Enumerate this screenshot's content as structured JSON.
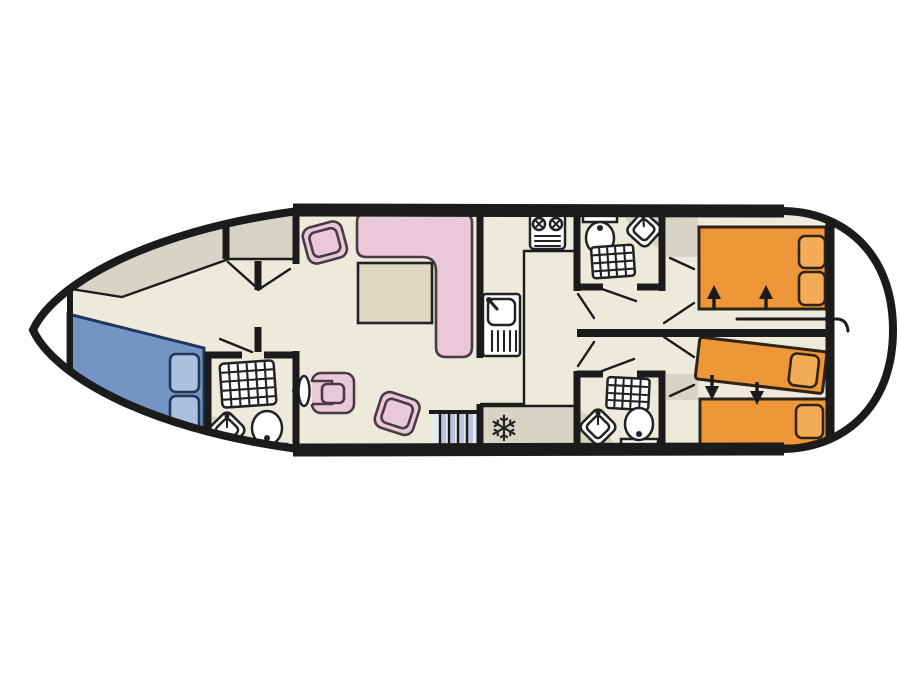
{
  "figure": {
    "type": "floor-plan",
    "subject": "Top-down deck plan of a motor cruiser / canal boat",
    "orientation": "bow-left-stern-right",
    "visible_text": "none"
  },
  "icons": {
    "snowflake": "❄"
  },
  "colors": {
    "background": "#ffffff",
    "hull": "#1b1b1b",
    "floor": "#edeadb",
    "deck_gray": "#d7d4c5",
    "bed_blue": "#7295c4",
    "pillow_blue": "#abc0dd",
    "bed_orange": "#ee9738",
    "pillow_orange": "#f3ab55",
    "furniture_pink": "#e9c9d8",
    "table_beige": "#ded9c2",
    "fixture_white": "#ffffff",
    "stair_bg": "#e7e9f2",
    "stair_blue": "#bcc3da"
  },
  "inventory": {
    "rooms": [
      {
        "name": "bow deck",
        "items": []
      },
      {
        "name": "bow cabin",
        "items": [
          "double bed (blue) with 2 pillows",
          "stowage shelf (gray)"
        ]
      },
      {
        "name": "forward bathroom",
        "items": [
          "shower tray",
          "corner basin",
          "toilet"
        ]
      },
      {
        "name": "saloon",
        "items": [
          "L-shaped sofa",
          "table",
          "armchair",
          "armchair",
          "helm seat",
          "steering wheel",
          "stairs"
        ]
      },
      {
        "name": "galley",
        "items": [
          "2-burner stove",
          "sink with drainer",
          "fridge (snowflake symbol)"
        ]
      },
      {
        "name": "midship bathroom top",
        "items": [
          "toilet",
          "corner basin",
          "shower tray"
        ]
      },
      {
        "name": "midship bathroom bottom",
        "items": [
          "shower tray",
          "corner basin",
          "toilet"
        ]
      },
      {
        "name": "aft cabin top",
        "items": [
          "double bed (orange) with 2 pillows",
          "wardrobe",
          "2 up arrows (sliding bed)"
        ]
      },
      {
        "name": "aft cabin bottom",
        "items": [
          "angled single bed (orange) with pillow",
          "single bed (orange) with pillow",
          "wardrobe",
          "2 down arrows (sliding bed)"
        ]
      },
      {
        "name": "stern",
        "items": []
      }
    ],
    "counts": {
      "toilets": 3,
      "showers": 3,
      "corner_basins": 3,
      "beds": 4,
      "arrows": 4
    }
  }
}
